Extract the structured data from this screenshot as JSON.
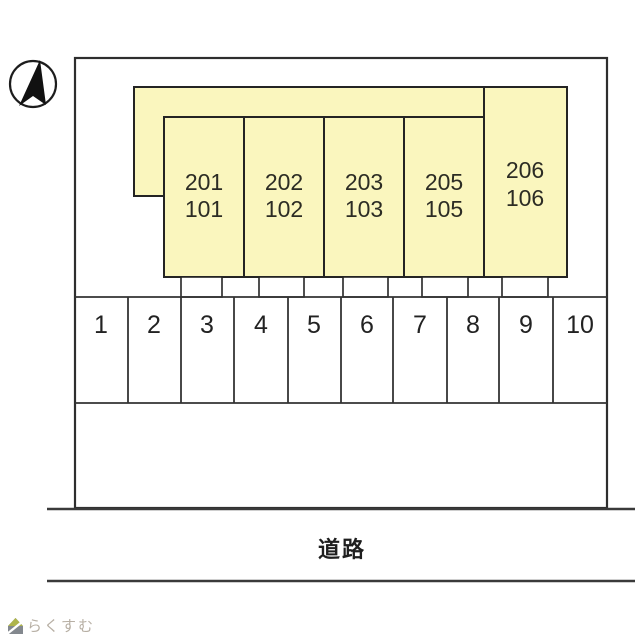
{
  "diagram": {
    "kind": "apartment-site-plan",
    "colors": {
      "unit_fill": "#FAF6BE",
      "line": "#2e2e2e",
      "watermark": "#b7afa4",
      "logo_roof": "#aeb44c",
      "logo_base": "#83888e"
    },
    "building": {
      "units": [
        {
          "upper": "201",
          "lower": "101"
        },
        {
          "upper": "202",
          "lower": "102"
        },
        {
          "upper": "203",
          "lower": "103"
        },
        {
          "upper": "205",
          "lower": "105"
        },
        {
          "upper": "206",
          "lower": "106"
        }
      ]
    },
    "parking": {
      "spaces": [
        "1",
        "2",
        "3",
        "4",
        "5",
        "6",
        "7",
        "8",
        "9",
        "10"
      ]
    },
    "road": {
      "label": "道路"
    },
    "watermark": {
      "text": "らくすむ"
    }
  }
}
